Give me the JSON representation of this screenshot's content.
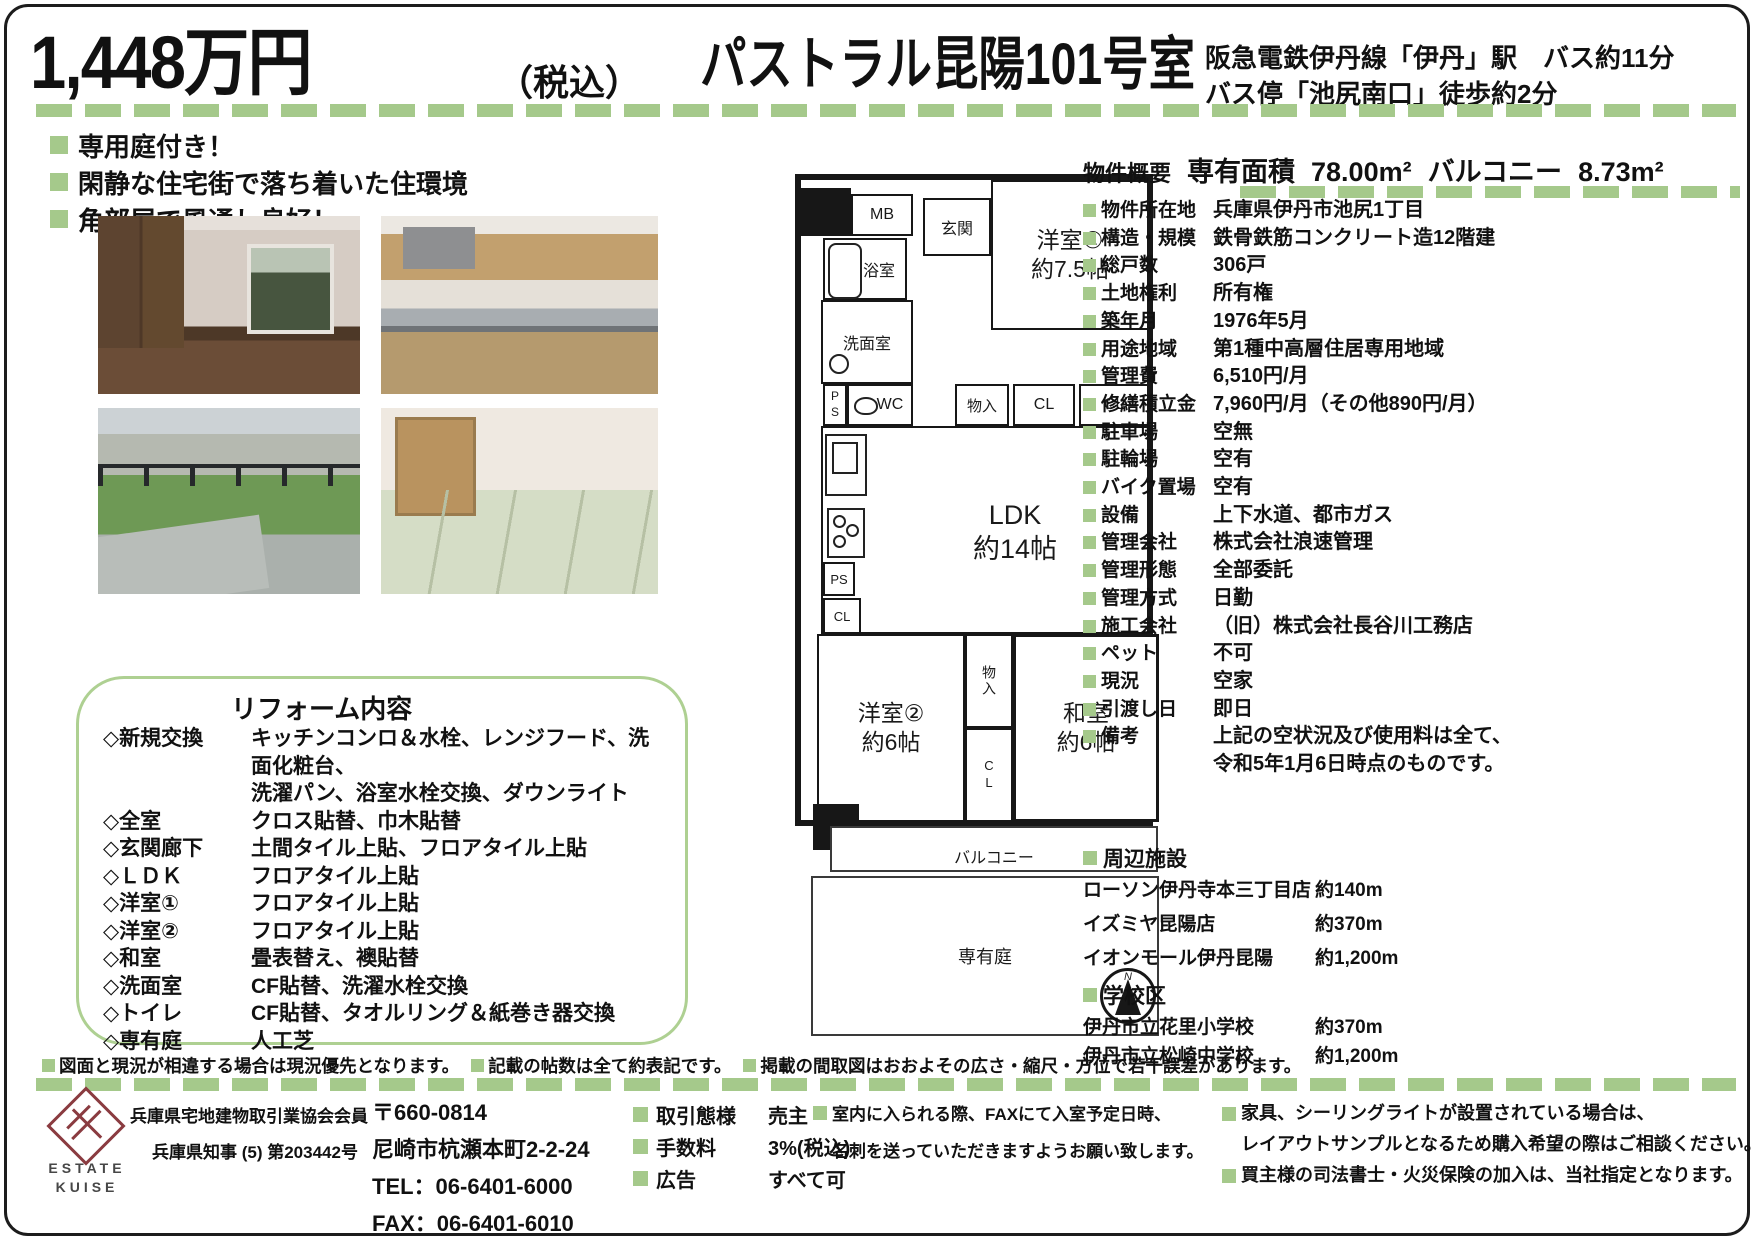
{
  "colors": {
    "accent_green": "#a5c98b",
    "logo_maroon": "#8a3b40"
  },
  "header": {
    "price": "1,448万円",
    "tax_note": "（税込）",
    "property_name": "パストラル昆陽101号室",
    "access_line1": "阪急電鉄伊丹線「伊丹」駅　バス約11分",
    "access_line2": "バス停「池尻南口」徒歩約2分"
  },
  "features": [
    {
      "text": "専用庭付き！"
    },
    {
      "text": "閑静な住宅街で落ち着いた住環境"
    },
    {
      "text": "角部屋で風通し良好！"
    }
  ],
  "reform": {
    "title": "リフォーム内容",
    "items": [
      {
        "label": "◇新規交換",
        "value": "キッチンコンロ＆水栓、レンジフード、洗面化粧台、\n洗濯パン、浴室水栓交換、ダウンライト"
      },
      {
        "label": "◇全室",
        "value": "クロス貼替、巾木貼替"
      },
      {
        "label": "◇玄関廊下",
        "value": "土間タイル上貼、フロアタイル上貼"
      },
      {
        "label": "◇ＬＤＫ",
        "value": "フロアタイル上貼"
      },
      {
        "label": "◇洋室①",
        "value": "フロアタイル上貼"
      },
      {
        "label": "◇洋室②",
        "value": "フロアタイル上貼"
      },
      {
        "label": "◇和室",
        "value": "畳表替え、襖貼替"
      },
      {
        "label": "◇洗面室",
        "value": "CF貼替、洗濯水栓交換"
      },
      {
        "label": "◇トイレ",
        "value": "CF貼替、タオルリング＆紙巻き器交換"
      },
      {
        "label": "◇専有庭",
        "value": "人工芝"
      }
    ]
  },
  "floorplan": {
    "labels": {
      "mb": "MB",
      "genkan": "玄関",
      "bath": "浴室",
      "washroom": "洗面室",
      "ps": "PS",
      "wc": "WC",
      "storage": "物入",
      "closet": "CL",
      "room1": "洋室①",
      "room1_size": "約7.5帖",
      "ldk": "LDK",
      "ldk_size": "約14帖",
      "room2": "洋室②",
      "room2_size": "約6帖",
      "washitsu": "和室",
      "washitsu_size": "約6帖",
      "balcony": "バルコニー",
      "garden": "専有庭",
      "north": "N"
    }
  },
  "overview": {
    "section_label": "物件概要",
    "area_label": "専有面積",
    "area_value": "78.00m²",
    "balcony_label": "バルコニー",
    "balcony_value": "8.73m²",
    "rows": [
      {
        "label": "物件所在地",
        "value": "兵庫県伊丹市池尻1丁目"
      },
      {
        "label": "構造・規模",
        "value": "鉄骨鉄筋コンクリート造12階建"
      },
      {
        "label": "総戸数",
        "value": "306戸"
      },
      {
        "label": "土地権利",
        "value": "所有権"
      },
      {
        "label": "築年月",
        "value": "1976年5月"
      },
      {
        "label": "用途地域",
        "value": "第1種中高層住居専用地域"
      },
      {
        "label": "管理費",
        "value": "6,510円/月"
      },
      {
        "label": "修繕積立金",
        "value": "7,960円/月（その他890円/月）"
      },
      {
        "label": "駐車場",
        "value": "空無"
      },
      {
        "label": "駐輪場",
        "value": "空有"
      },
      {
        "label": "バイク置場",
        "value": "空有"
      },
      {
        "label": "設備",
        "value": "上下水道、都市ガス"
      },
      {
        "label": "管理会社",
        "value": "株式会社浪速管理"
      },
      {
        "label": "管理形態",
        "value": "全部委託"
      },
      {
        "label": "管理方式",
        "value": "日勤"
      },
      {
        "label": "施工会社",
        "value": "（旧）株式会社長谷川工務店"
      },
      {
        "label": "ペット",
        "value": "不可"
      },
      {
        "label": "現況",
        "value": "空家"
      },
      {
        "label": "引渡し日",
        "value": "即日"
      },
      {
        "label": "備考",
        "value": "上記の空状況及び使用料は全て、\n令和5年1月6日時点のものです。"
      }
    ]
  },
  "nearby": {
    "title": "周辺施設",
    "items": [
      {
        "name": "ローソン伊丹寺本三丁目店",
        "distance": "約140m"
      },
      {
        "name": "イズミヤ昆陽店",
        "distance": "約370m"
      },
      {
        "name": "イオンモール伊丹昆陽",
        "distance": "約1,200m"
      }
    ]
  },
  "schools": {
    "title": "学校区",
    "items": [
      {
        "name": "伊丹市立花里小学校",
        "distance": "約370m"
      },
      {
        "name": "伊丹市立松崎中学校",
        "distance": "約1,200m"
      }
    ]
  },
  "disclaimers": [
    {
      "text": "図面と現況が相違する場合は現況優先となります。"
    },
    {
      "text": "記載の帖数は全て約表記です。"
    },
    {
      "text": "掲載の間取図はおおよその広さ・縮尺・方位で若干誤差があります。"
    }
  ],
  "footer": {
    "logo_line1": "ESTATE",
    "logo_line2": "KUISE",
    "member": "兵庫県宅地建物取引業協会会員",
    "license": "兵庫県知事 (5) 第203442号",
    "postal": "〒660-0814",
    "address": "尼崎市杭瀬本町2-2-24",
    "tel": "TEL：06-6401-6000",
    "fax": "FAX：06-6401-6010",
    "terms": [
      {
        "label": "取引態様",
        "value": "売主"
      },
      {
        "label": "手数料",
        "value": "3%(税込)"
      },
      {
        "label": "広告",
        "value": "すべて可"
      }
    ],
    "notice_fax_line1": "室内に入られる際、FAXにて入室予定日時、",
    "notice_fax_line2": "名刺を送っていただきますようお願い致します。",
    "notice_furniture_line1": "家具、シーリングライトが設置されている場合は、",
    "notice_furniture_line2": "レイアウトサンプルとなるため購入希望の際はご相談ください。",
    "notice_insurance": "買主様の司法書士・火災保険の加入は、当社指定となります。"
  }
}
